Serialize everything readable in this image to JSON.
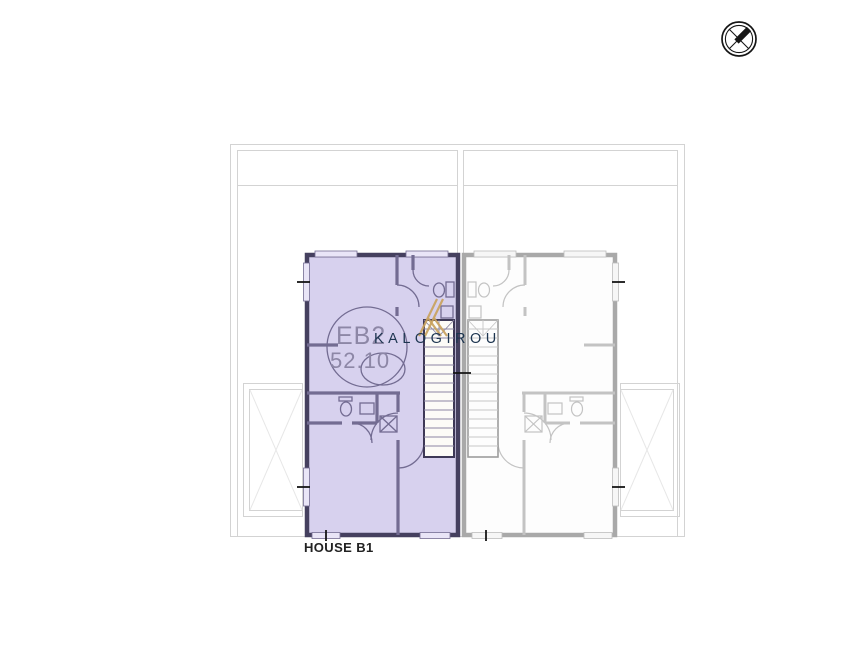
{
  "plan": {
    "unit": {
      "code": "EB2",
      "area": "52.10",
      "name": "HOUSE B1"
    },
    "watermark": {
      "text": "KALOGIROU",
      "logo_icon": "kalogirou-k-logo"
    },
    "compass_icon": "north-compass-icon",
    "colors": {
      "page_bg": "#ffffff",
      "highlight_fill": "#d7d1ee",
      "highlight_wall": "#45405f",
      "highlight_inner": "#736c92",
      "neighbor_wall": "#a9a9a9",
      "neighbor_inner": "#c3c3c3",
      "site_line": "#d3d3d3",
      "faint_line": "#e7e7e7",
      "label_text": "#8d87a6",
      "watermark_text": "#1d3550",
      "logo_gold": "#c9a25e",
      "house_label": "#222222",
      "tick_black": "#151515"
    }
  }
}
